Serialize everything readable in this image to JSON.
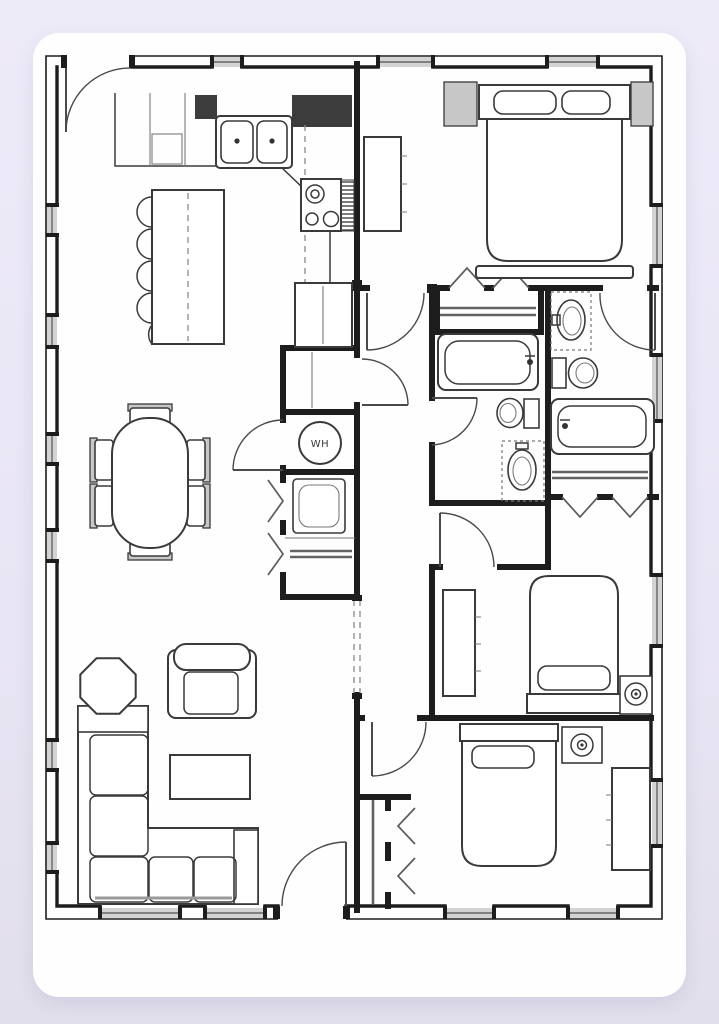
{
  "colors": {
    "background_top": "#eeebf9",
    "background_mid": "#e8e5f4",
    "background_bottom": "#e2dfec",
    "card": "#fefefe",
    "wall": "#1d1d1d",
    "line": "#3a3a3a",
    "shade": "#c7c7c7",
    "window_glass": "#d3d3d3"
  },
  "plan": {
    "water_heater_label": "WH",
    "drawing_type": "single-story house floor plan, black line work on white card",
    "fixtures": [
      "back-door",
      "kitchen-counter",
      "double-basin-sink",
      "range-with-burners",
      "vent-hatch",
      "refrigerator-pantry",
      "kitchen-island",
      "island-stools",
      "dining-table",
      "dining-chairs",
      "linen-closet",
      "water-heater",
      "laundry-closet",
      "washer-unit",
      "hall-bathtub",
      "hall-toilet",
      "hall-vanity-sink",
      "master-bathtub",
      "master-toilet",
      "master-vanity-sink",
      "bed-master",
      "bed-middle",
      "bed-rear",
      "nightstands",
      "dressers",
      "lamps",
      "closet-rods",
      "bifold-closet-doors",
      "sectional-sofa",
      "armchair",
      "coffee-table",
      "octagon-end-table",
      "front-door",
      "windows"
    ]
  }
}
